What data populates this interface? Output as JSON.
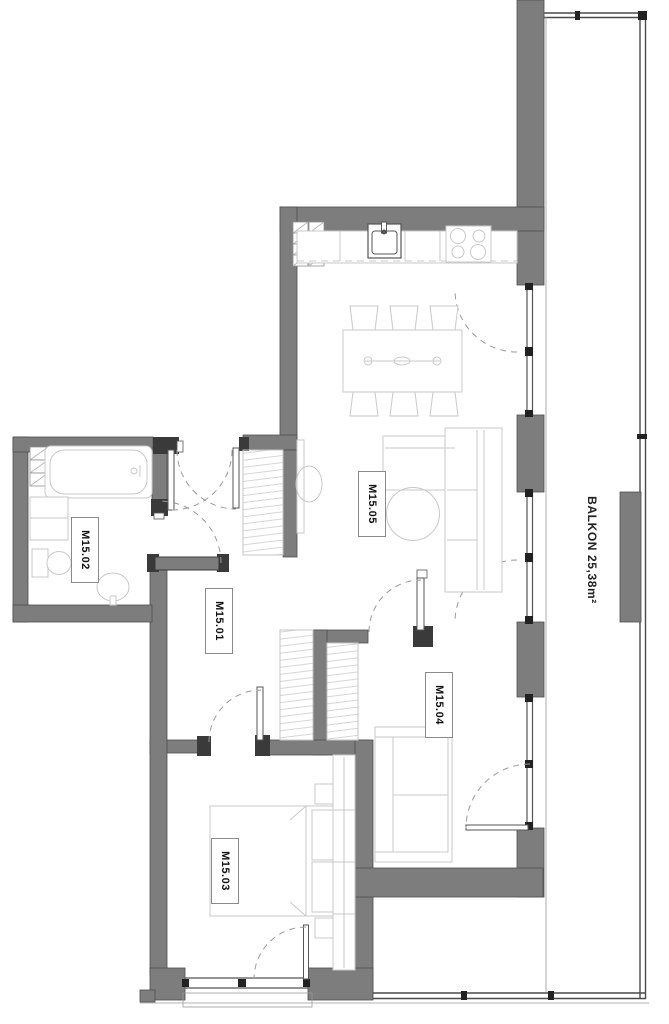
{
  "title": "Apartment floor plan M15",
  "rooms": {
    "hallway": {
      "label": "M15.01"
    },
    "bathroom": {
      "label": "M15.02"
    },
    "bedroom": {
      "label": "M15.03"
    },
    "room2": {
      "label": "M15.04"
    },
    "living": {
      "label": "M15.05"
    },
    "balcony": {
      "label": "BALKON 25,38m²",
      "area_m2": "25,38"
    }
  },
  "colors": {
    "wall": "#7d7d7d",
    "wall-edge": "#4f4f4f",
    "jamb": "#3a3a3a",
    "furniture": "#c9c9c9",
    "arc": "#9a9a9a"
  }
}
